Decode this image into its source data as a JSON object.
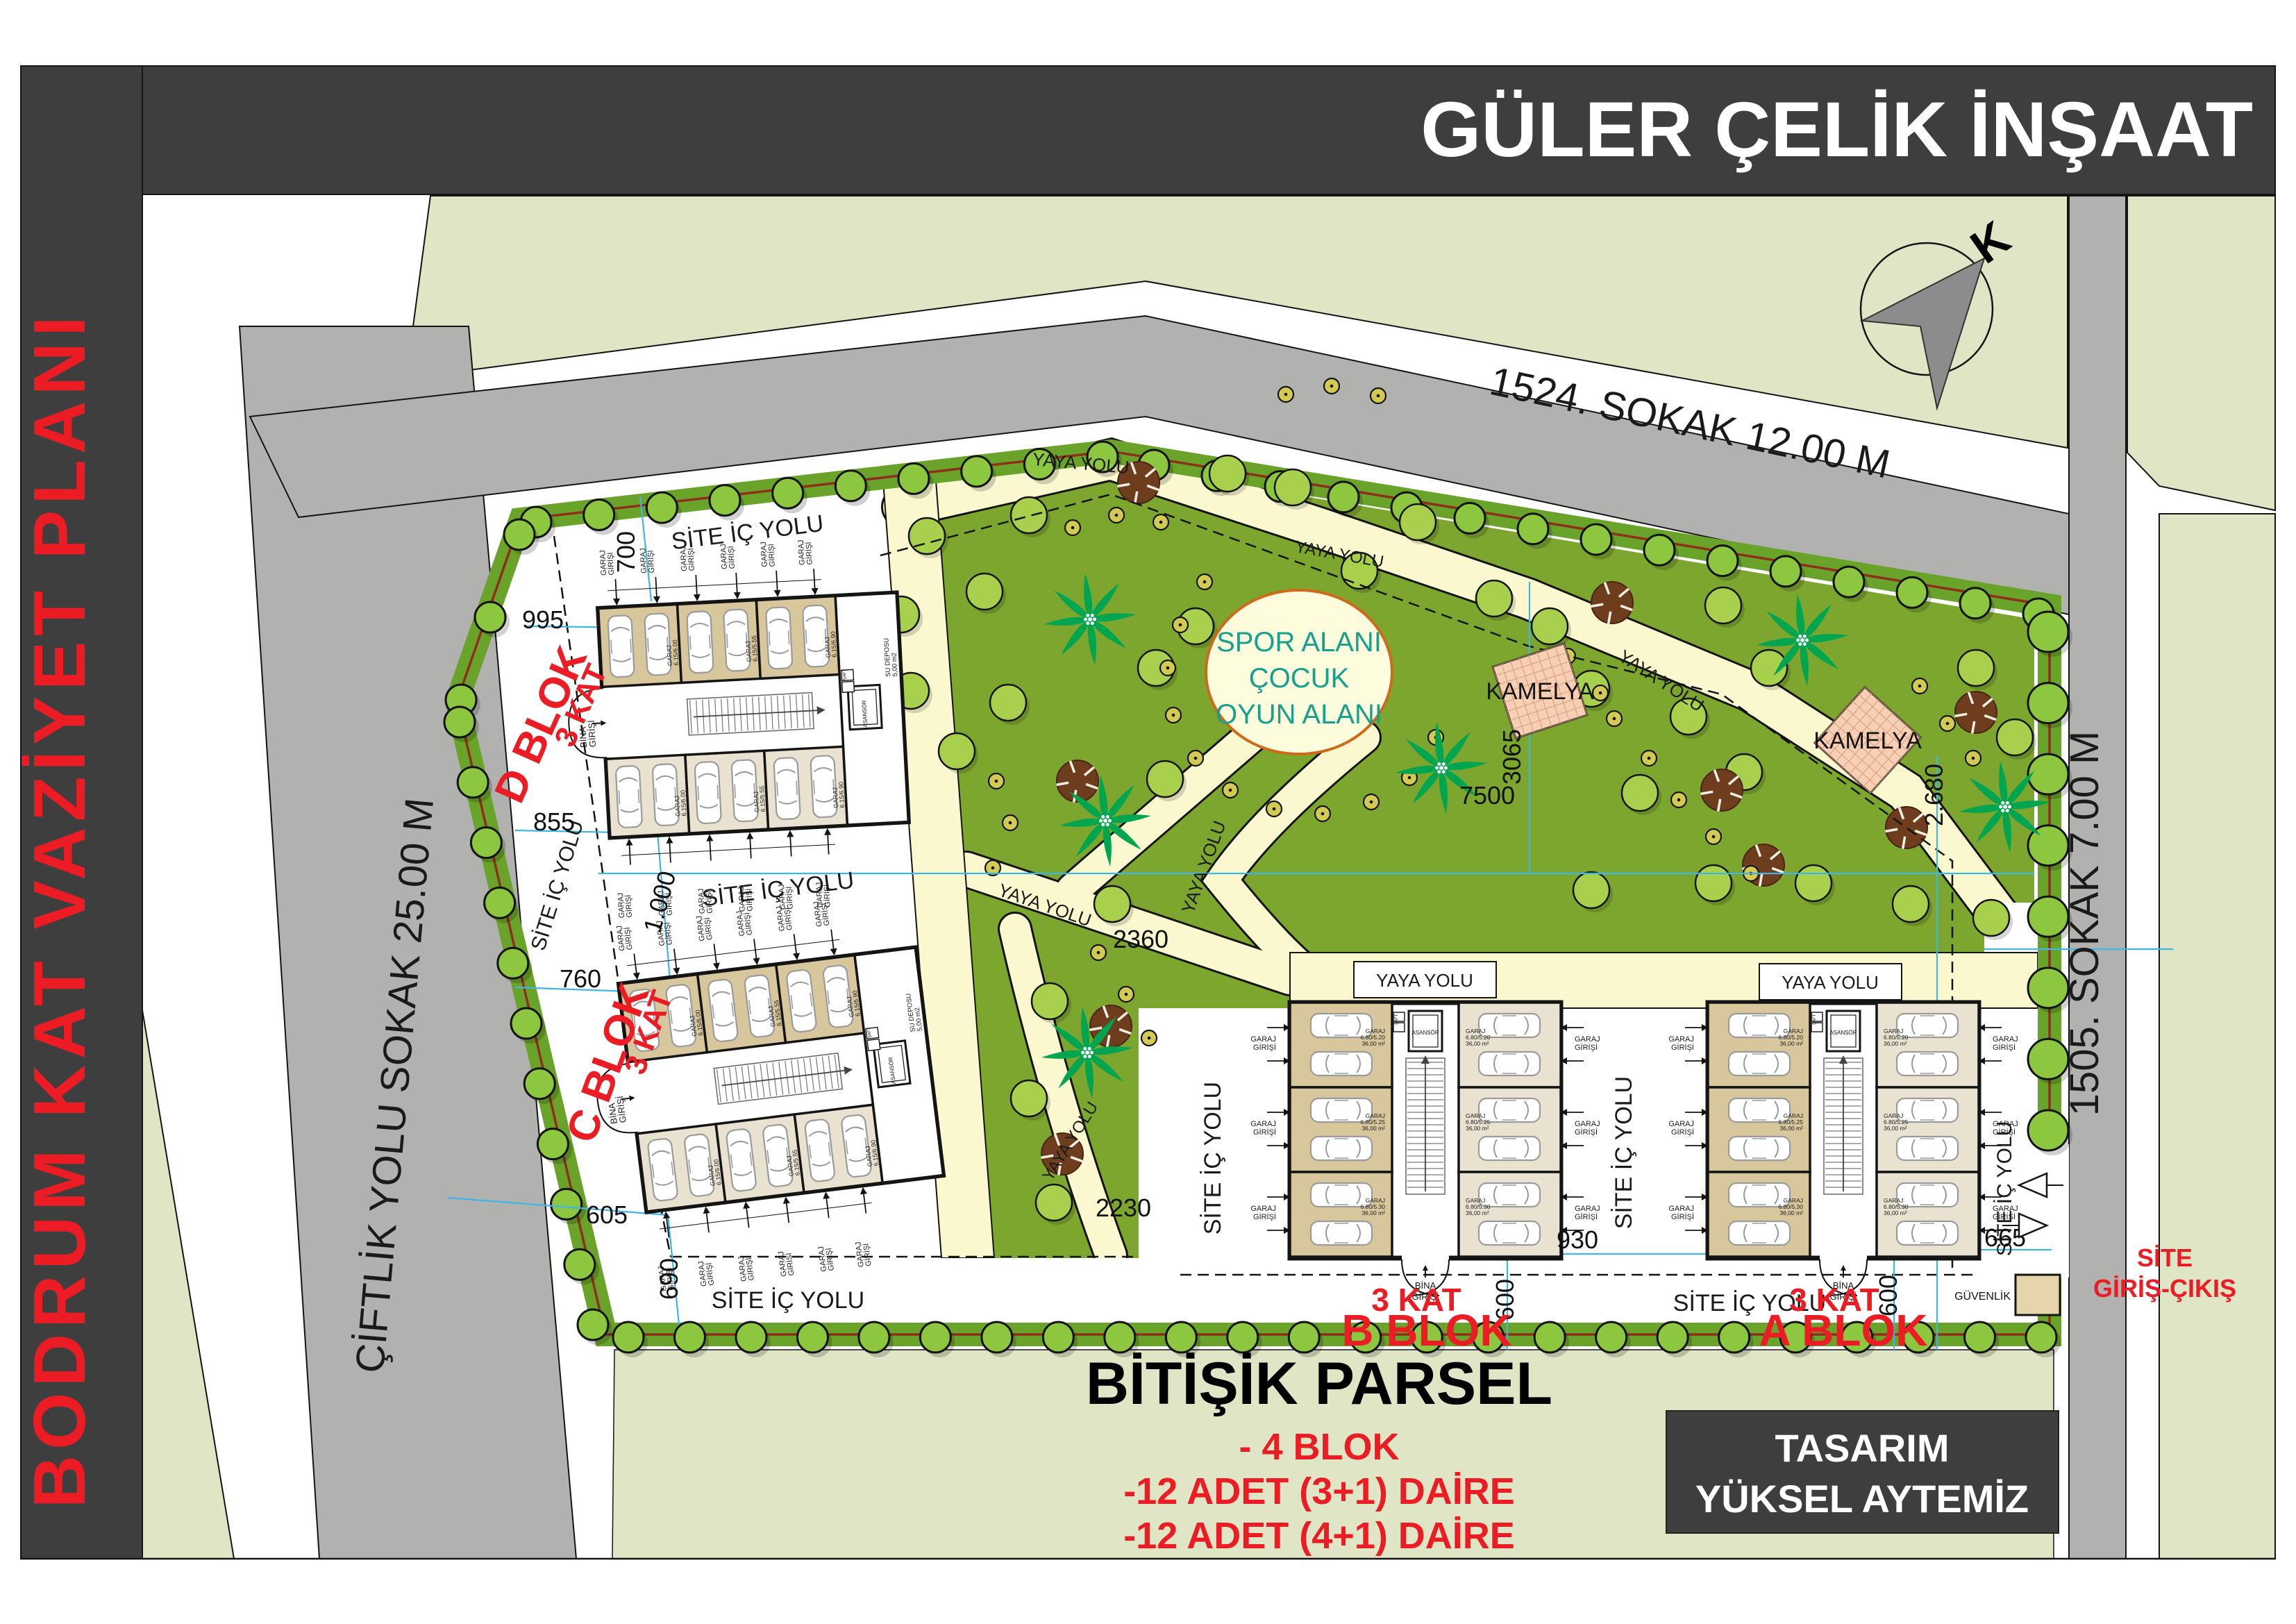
{
  "header": {
    "company": "GÜLER ÇELİK İNŞAAT",
    "plan_title": "BODRUM KAT VAZİYET PLANI"
  },
  "streets": {
    "top": "1524. SOKAK 12.00 M",
    "left": "ÇİFTLİK YOLU SOKAK 25.00 M",
    "right": "1505. SOKAK 7.00 M"
  },
  "north_letter": "K",
  "labels": {
    "site_ic_yolu": "SİTE İÇ YOLU",
    "yaya_yolu": "YAYA YOLU",
    "bitisik_parsel": "BİTİŞİK PARSEL",
    "guvenlik": "GÜVENLİK",
    "site_giris_1": "SİTE",
    "site_giris_2": "GİRİŞ-ÇIKIŞ"
  },
  "spor": {
    "line1": "SPOR ALANI",
    "line2": "ÇOCUK",
    "line3": "OYUN ALANI"
  },
  "kamelya": "KAMELYA",
  "blocks": {
    "kat": "3 KAT",
    "a": "A BLOK",
    "b": "B BLOK",
    "c": "C BLOK",
    "d": "D BLOK"
  },
  "garage": {
    "garaj": "GARAJ",
    "girisi": "GİRİŞİ",
    "bina": "BİNA",
    "asansor": "ASANSÖR",
    "saft": "ŞAFT",
    "su_deposu_1": "SU DEPOSU",
    "su_deposu_2": "5,00 m2",
    "dc_sizes": [
      "6.15/6.00",
      "6.15/5.55",
      "6.15/6.90"
    ],
    "dc_areas": [
      "37,00 m2",
      "35,00 m2",
      "42,50 m2"
    ],
    "ab_sizes": [
      "6.80/5.20",
      "6.80/5.25",
      "6.80/5.30"
    ],
    "ab_area": "36,00 m²"
  },
  "dimensions": {
    "dim_700": "700",
    "dim_995": "995",
    "dim_855": "855",
    "dim_1000": "1.000",
    "dim_760": "760",
    "dim_605": "605",
    "dim_690": "690",
    "dim_2360": "2360",
    "dim_2230": "2230",
    "dim_3065": "3065",
    "dim_7500": "7500",
    "dim_2680": "2.680",
    "dim_930": "930",
    "dim_600": "600",
    "dim_665": "665"
  },
  "program": [
    "- 4 BLOK",
    "-12 ADET (3+1) DAİRE",
    "-12 ADET (4+1) DAİRE"
  ],
  "design_box": {
    "line1": "TASARIM",
    "line2": "YÜKSEL AYTEMİZ"
  },
  "colors": {
    "band": "#3e3e3e",
    "red": "#ec1c24",
    "road_gray": "#b1b1af",
    "pale_parcel": "#e0e5c5",
    "park_green": "#7da62f",
    "strip_olive": "#6aa32a",
    "boundary_red": "#8c2f1b",
    "street_tree": "#8dc63f",
    "park_tree": "#a9d04c",
    "dot_tree": "#d2ca52",
    "brown_tree": "#6e3d1d",
    "palm": "#00a550",
    "cream_path": "#fbf8d0",
    "circle_fill": "#fdfcdc",
    "circle_stroke": "#cf6a1a",
    "spor_text": "#17a08d",
    "kamelya_fill": "#f7cfb5",
    "kamelya_grid": "#d89a74",
    "garage_dark": "#d8c69c",
    "garage_light": "#eae2d0",
    "dim_blue": "#3fb6e8",
    "car_line": "#9b9b9b"
  }
}
